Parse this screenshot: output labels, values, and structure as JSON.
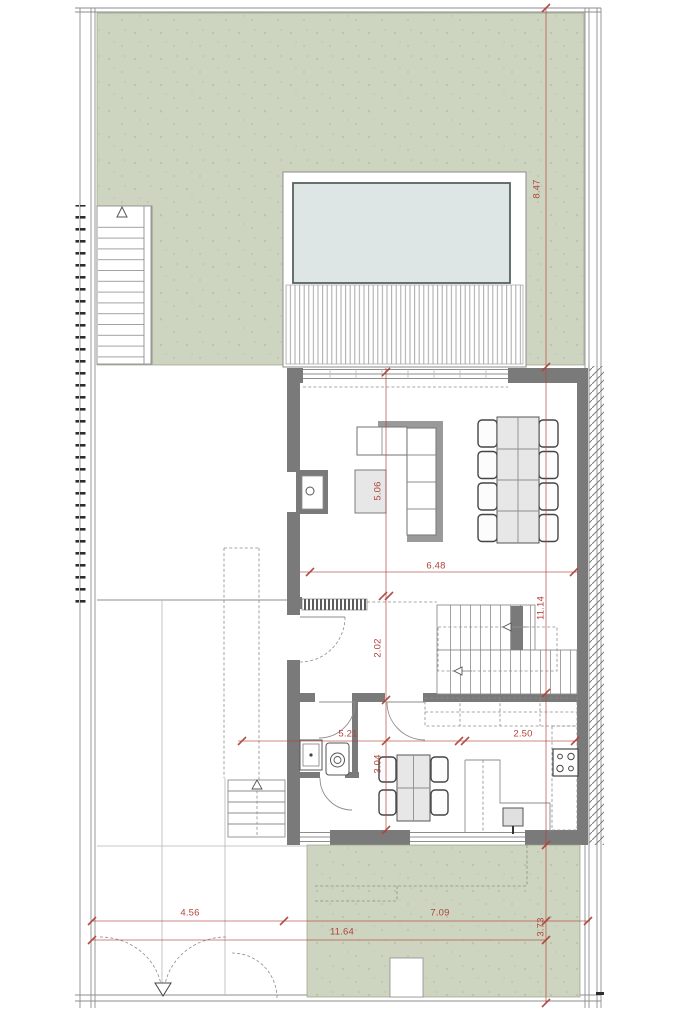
{
  "document_type": "architectural floor plan drawing",
  "colors": {
    "garden_green": "#cdd4bf",
    "pool_blue": "#dde6e5",
    "wall_gray": "#7a7a7a",
    "dim_red": "#b0443c",
    "furniture_gray": "#e7e7e7"
  },
  "dimensions": {
    "site_right_upper": "8.47",
    "house_right": "11.14",
    "garden_bottom_right": "3.73",
    "living_width": "6.48",
    "living_height": "5.06",
    "hall_height": "2.02",
    "kitchen_height": "3.04",
    "kitchen_left_width": "5.21",
    "kitchen_right_width": "2.50",
    "driveway_width": "4.56",
    "garden_bottom_width": "7.09",
    "site_bottom_width": "11.64"
  }
}
